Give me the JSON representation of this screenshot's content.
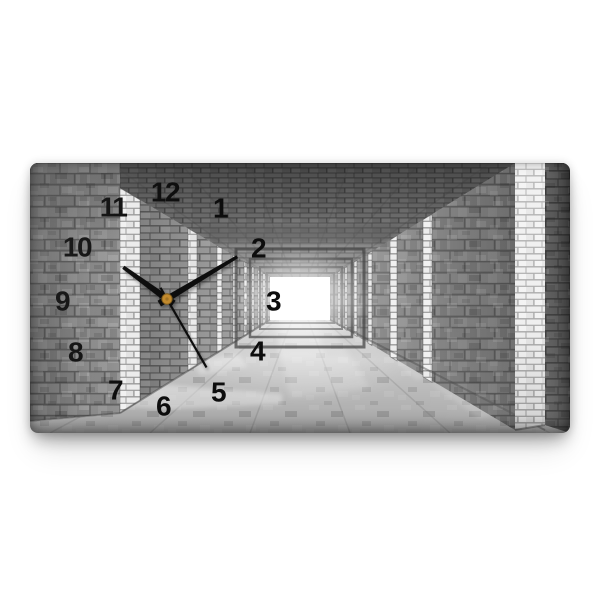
{
  "product_photo": {
    "background_color": "#ffffff",
    "subject": "horizontal-glass-wall-clock-with-3d-brick-tunnel-print"
  },
  "clock": {
    "numerals": [
      "12",
      "1",
      "2",
      "3",
      "4",
      "5",
      "6",
      "7",
      "8",
      "9",
      "10",
      "11"
    ],
    "time_shown": "10:10:25",
    "colors": {
      "numerals": "#0d0d0d",
      "hands": "#0b0b0b",
      "center_pin": "#c28a2e",
      "tunnel_light": "#ffffff",
      "brick_gray": "#8d8d8d",
      "floor_gray": "#cdcdcd"
    }
  }
}
